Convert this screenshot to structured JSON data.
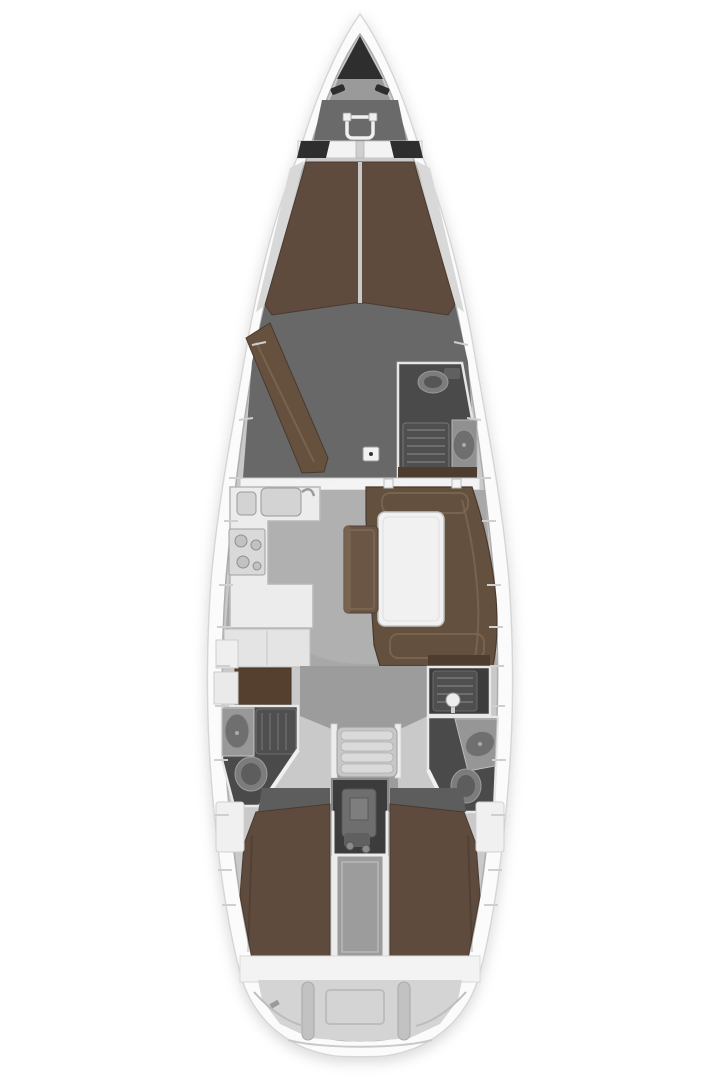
{
  "subject": "Sailing yacht interior deck plan, top-down view, bow at top",
  "palette": {
    "background": "#ffffff",
    "hull_white": "#fbfbfb",
    "deck_base": "#c9c9c9",
    "foredeck_gray": "#9a9a9a",
    "foredeck_dark": "#6a6a6a",
    "anchor_dark": "#2e2e2e",
    "white_trim": "#f3f3f3",
    "shelf_gray": "#d8d8d8",
    "berth_brown": "#5f4b3d",
    "sofa_brown": "#66513f",
    "settee_brown": "#63503f",
    "bench_brown": "#6b5646",
    "locker_brown": "#553f2f",
    "wood_dark": "#4e3c2f",
    "counter_white": "#ececec",
    "appliance_gray": "#d9d9d9",
    "table_white": "#f1f1f1",
    "floor_salon": "#a8a8a8",
    "floor_fwd": "#686868",
    "floor_mid": "#9c9c9c",
    "floor_entrance_dark": "#5d5d5d",
    "room_dark": "#4a4a4a",
    "engine_dark": "#3c3c3c",
    "engine_block": "#6e6e6e",
    "fixture_gray": "#7c7c7c",
    "fixture_dark": "#6f6f6f",
    "grate_gray": "#4f4f4f",
    "steps_gray": "#c7c7c7",
    "tread_gray": "#dadada",
    "transom_gray": "#d4d4d4",
    "sink_basin": "#d3d3d3"
  },
  "features": [
    "anchor-locker",
    "windlass",
    "bow-cleats",
    "v-berth",
    "forward-sofa",
    "forward-head",
    "toilet",
    "shower-grate",
    "washbasin",
    "galley",
    "double-sink",
    "stove",
    "fridge-counter",
    "saloon-settee",
    "saloon-table",
    "bench-seat",
    "companionway-steps",
    "engine-compartment",
    "aft-head-port",
    "aft-head-starboard",
    "aft-berth-port",
    "aft-berth-starboard",
    "transom",
    "swim-platform"
  ]
}
